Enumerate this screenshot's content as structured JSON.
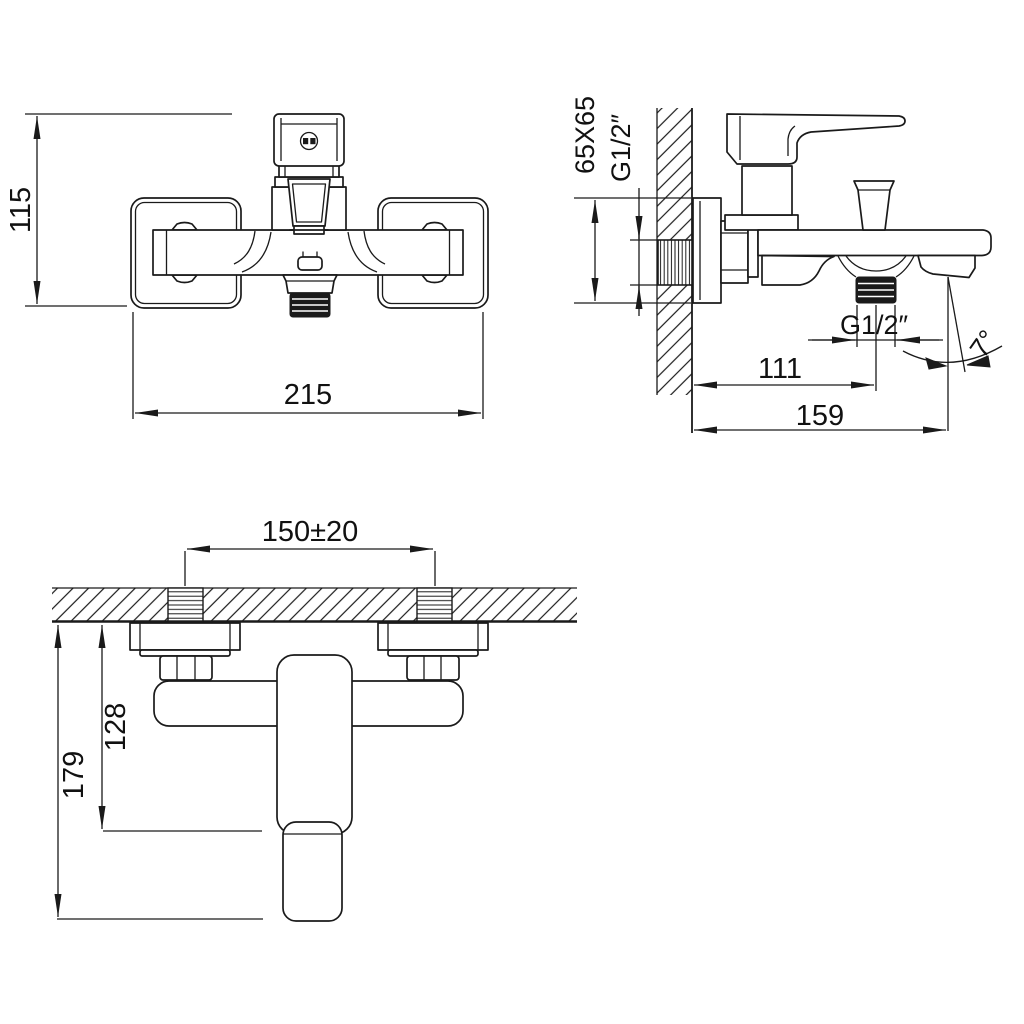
{
  "drawing": {
    "background": "#ffffff",
    "ink": "#1a1a1a",
    "front_view": {
      "height_mm": "115",
      "overall_width_mm": "215"
    },
    "side_view": {
      "wall_plate_size": "65X65",
      "inlet_thread": "G1/2″",
      "outlet_thread": "G1/2″",
      "wall_to_outlet_mm": "111",
      "wall_to_spout_mm": "159",
      "spout_angle": "7°"
    },
    "top_view": {
      "hole_spacing_mm": "150±20",
      "body_depth_mm": "128",
      "handle_depth_mm": "179"
    }
  }
}
